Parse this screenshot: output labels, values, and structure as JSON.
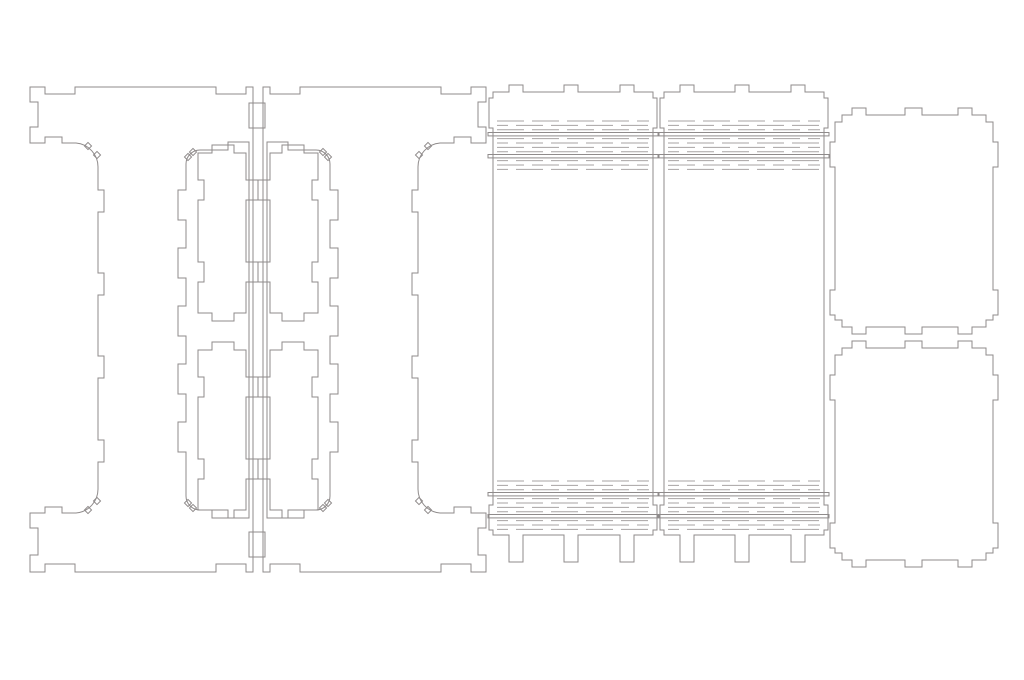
{
  "canvas": {
    "width": 1024,
    "height": 680,
    "background": "#ffffff"
  },
  "drawing": {
    "stroke_color": "#8f8b8b",
    "hinge_dash_color": "#a7a3a3",
    "stroke_width": 1
  },
  "parts": [
    {
      "name": "side-panel-left",
      "d": "M30,87 L45,87 L45,94 L75,94 L75,87 L216,87 L216,94 L246,94 L246,87 L253,87 L253,572 L246,572 L246,564 L216,564 L216,572 L75,572 L75,564 L45,564 L45,572 L30,572 L30,555 L38,555 L38,528 L30,528 L30,513 L45,513 L45,507 L62,507 L62,513 L76,513 A24,24 0 0 0 98,489 L98,462 L104,462 L104,440 L98,440 L98,378 L104,378 L104,356 L98,356 L98,295 L104,295 L104,273 L98,273 L98,212 L104,212 L104,190 L98,190 L98,167 A24,24 0 0 0 76,143 L62,143 L62,137 L45,137 L45,143 L30,143 L30,127 L38,127 L38,102 L30,102 Z M200,150 L228,150 L228,142 L249,142 L249,518 L228,518 L228,510 L200,510 A14,14 0 0 1 186,496 L186,452 L178,452 L178,422 L186,422 L186,394 L178,394 L178,364 L186,364 L186,336 L178,336 L178,306 L186,306 L186,278 L178,278 L178,248 L186,248 L186,220 L178,220 L178,190 L186,190 L186,164 A14,14 0 0 1 200,150 Z",
      "teeth": [
        [
          97,
          155
        ],
        [
          88,
          146
        ],
        [
          97,
          501
        ],
        [
          88,
          510
        ],
        [
          193,
          152
        ],
        [
          188,
          157
        ],
        [
          193,
          508
        ],
        [
          188,
          503
        ]
      ]
    },
    {
      "name": "side-panel-right",
      "d_ref": "side-panel-left",
      "transform": "translate(516,0) scale(-1,1)"
    },
    {
      "name": "divider-slat-top-left",
      "d": "M198,153 L212,153 L212,145 L234,145 L234,153 L246,153 L246,180 L258,180 L258,200 L246,200 L246,262 L258,262 L258,282 L246,282 L246,313 L234,313 L234,321 L212,321 L212,313 L198,313 L198,282 L204,282 L204,262 L198,262 L198,200 L204,200 L204,180 L198,180 Z"
    },
    {
      "name": "divider-slat-bottom-left",
      "d_ref": "divider-slat-top-left",
      "transform": "translate(0,197)"
    },
    {
      "name": "divider-slat-top-right",
      "d_ref": "divider-slat-top-left",
      "transform": "translate(516,0) scale(-1,1)"
    },
    {
      "name": "divider-slat-bottom-right",
      "d_ref": "divider-slat-top-left",
      "transform": "translate(516,197) scale(-1,1)"
    },
    {
      "name": "flex-panel-left",
      "d": "M493,92 L509,92 L509,85 L523,85 L523,92 L564,92 L564,85 L578,85 L578,92 L620,92 L620,85 L634,85 L634,92 L653,92 L653,98 L657,98 L657,128 L653,128 L653,505 L657,505 L657,530 L653,530 L653,535 L634,535 L634,562 L620,562 L620,535 L578,535 L578,562 L564,562 L564,535 L523,535 L523,562 L509,562 L509,535 L493,535 L493,530 L489,530 L489,505 L493,505 L493,128 L489,128 L489,98 L493,98 Z"
    },
    {
      "name": "flex-panel-right",
      "d_ref": "flex-panel-left",
      "transform": "translate(171,0)"
    },
    {
      "name": "lid-panel-top",
      "d": "M835,122 L842,122 L842,115 L852,115 L852,108 L866,108 L866,115 L905,115 L905,108 L922,108 L922,115 L958,115 L958,108 L972,108 L972,115 L986,115 L986,122 L993,122 L993,142 L998,142 L998,167 L993,167 L993,290 L998,290 L998,315 L993,315 L993,320 L986,320 L986,327 L972,327 L972,334 L958,334 L958,327 L922,327 L922,334 L905,334 L905,327 L866,327 L866,334 L852,334 L852,327 L842,327 L842,320 L835,320 L835,315 L830,315 L830,290 L835,290 L835,167 L830,167 L830,142 L835,142 Z"
    },
    {
      "name": "lid-panel-bottom",
      "d_ref": "lid-panel-top",
      "transform": "translate(0,233)"
    }
  ],
  "joint_boxes": [
    {
      "x": 249,
      "y": 103,
      "w": 16,
      "h": 25
    },
    {
      "x": 249,
      "y": 532,
      "w": 16,
      "h": 25
    }
  ],
  "hinge_style": {
    "rows": 12,
    "spacing": 4.4,
    "width": 152,
    "protrude": 9,
    "slot_rows": [
      3,
      8
    ],
    "slot_height": 3.4,
    "dash": "27 8",
    "stagger": 16
  },
  "hinges": [
    {
      "name": "hinge-band-left-top",
      "x": 497,
      "y": 121
    },
    {
      "name": "hinge-band-left-bottom",
      "x": 497,
      "y": 481
    },
    {
      "name": "hinge-band-right-top",
      "x": 668,
      "y": 121
    },
    {
      "name": "hinge-band-right-bottom",
      "x": 668,
      "y": 481
    }
  ],
  "teeth_style": {
    "size": 5
  }
}
